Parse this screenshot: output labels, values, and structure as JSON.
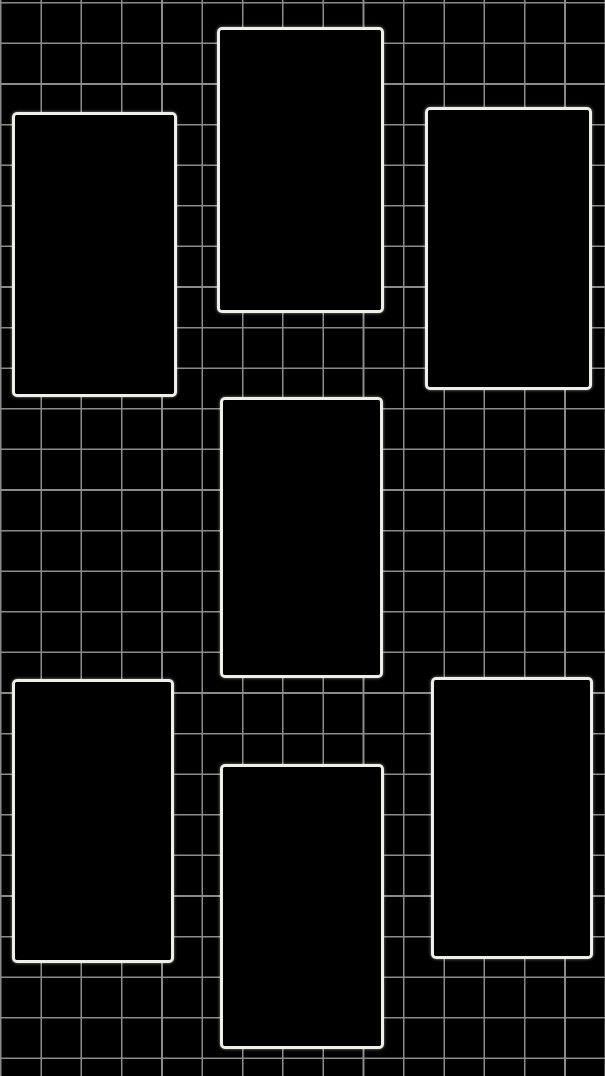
{
  "canvas": {
    "width": 605,
    "height": 1076,
    "background_color": "#000000"
  },
  "grid": {
    "line_color": "#8b8b8b",
    "line_width": 1.6,
    "spacing_x": 40.3,
    "spacing_y": 40.6,
    "offset_x": 0,
    "offset_y": 2
  },
  "frame_style": {
    "fill_color": "#000000",
    "border_color": "#efefe9",
    "border_width": 3,
    "corner_radius": 5
  },
  "frames": [
    {
      "name": "top-left",
      "x": 12,
      "y": 112,
      "width": 165,
      "height": 285
    },
    {
      "name": "top-middle",
      "x": 217,
      "y": 27,
      "width": 167,
      "height": 286
    },
    {
      "name": "top-right",
      "x": 425,
      "y": 107,
      "width": 167,
      "height": 283
    },
    {
      "name": "center",
      "x": 220,
      "y": 397,
      "width": 163,
      "height": 281
    },
    {
      "name": "bottom-left",
      "x": 12,
      "y": 679,
      "width": 162,
      "height": 284
    },
    {
      "name": "bottom-middle",
      "x": 220,
      "y": 764,
      "width": 164,
      "height": 285
    },
    {
      "name": "bottom-right",
      "x": 431,
      "y": 677,
      "width": 162,
      "height": 282
    }
  ]
}
